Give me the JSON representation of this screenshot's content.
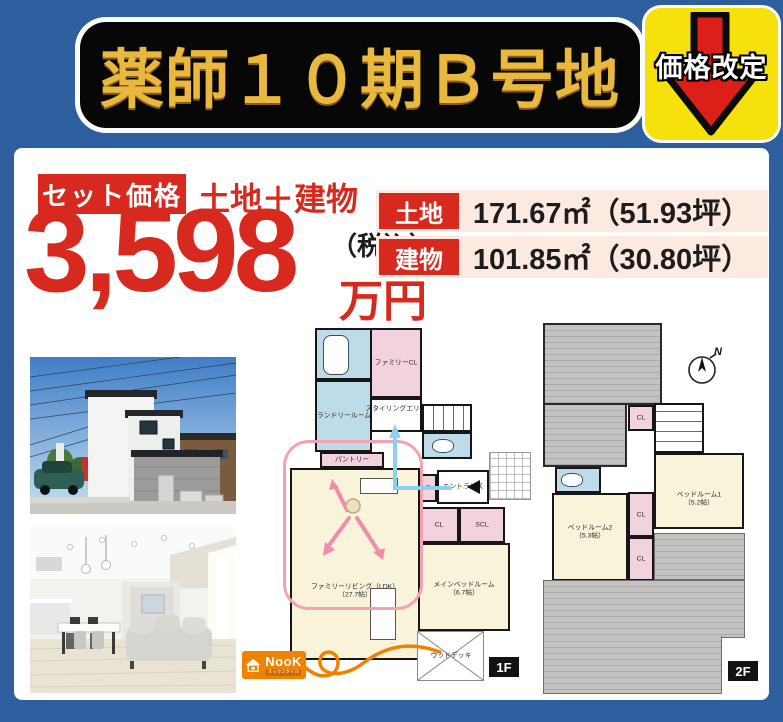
{
  "header": {
    "title": "薬師１０期Ｂ号地",
    "revision_badge": "価格改定"
  },
  "price": {
    "set_badge": "セット価格",
    "composition": "土地＋建物",
    "amount": "3,598",
    "tax_note": "（税込）",
    "unit": "万円"
  },
  "specs": {
    "rows": [
      {
        "label": "土地",
        "value": "171.67㎡（51.93坪）"
      },
      {
        "label": "建物",
        "value": "101.85㎡（30.80坪）"
      }
    ]
  },
  "floorplan_1f": {
    "badge": "1F",
    "laundry": "ランドリールーム",
    "family_closet": "ファミリーCL",
    "styling_area": "スタイリングエリア",
    "pantry": "パントリー",
    "entrance": "エントランス",
    "closet": "CL",
    "shoes_closet": "SCL",
    "living": "ファミリーリビング（LDK）",
    "living_size": "（27.7帖）",
    "main_bedroom": "メインベッドルーム",
    "main_bedroom_size": "（6.7帖）",
    "deck": "ウッドデッキ"
  },
  "floorplan_2f": {
    "badge": "2F",
    "closet": "CL",
    "bedroom1": "ベッドルーム1",
    "bedroom1_size": "（5.2帖）",
    "bedroom2": "ベッドルーム2",
    "bedroom2_size": "（5.3帖）",
    "compass": "N"
  },
  "logo": {
    "name": "NooK",
    "sub": "ヌックスタイル"
  },
  "colors": {
    "header_blue": "#2d5e9d",
    "accent_red": "#d8291e",
    "badge_yellow": "#f6e10a",
    "gold": "#e9b83e"
  }
}
